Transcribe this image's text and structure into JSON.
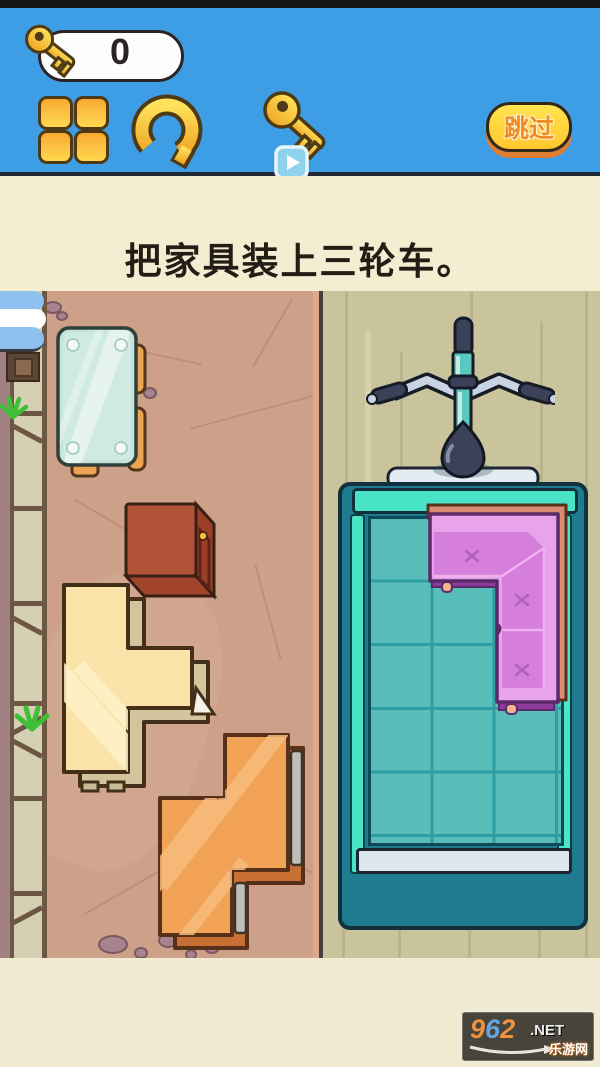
{
  "header": {
    "keys_count": "0",
    "skip_label": "跳过",
    "buttons": [
      "levels-grid",
      "restart",
      "key-hint-video",
      "skip"
    ],
    "accent_blue": "#3E9EE5",
    "gold": "#FFD23E"
  },
  "instruction": "把家具装上三轮车。",
  "game": {
    "goal": "load furniture pieces onto the tricycle cart",
    "cart": {
      "grid_columns": 3,
      "grid_rows": 5,
      "bed_color": "#59BDB9",
      "frame_color": "#1F7B90",
      "rail_color": "#4AE4C7",
      "loaded_piece": "purple-corner-sofa"
    },
    "pieces": [
      {
        "name": "glass-table",
        "color": "#C6E4DC",
        "shape": "rectangle"
      },
      {
        "name": "red-nightstand-box",
        "color": "#B25239",
        "shape": "cube"
      },
      {
        "name": "cream-sofa-piece",
        "color": "#FBE4A9",
        "shape": "T-tetromino"
      },
      {
        "name": "orange-wardrobe-piece",
        "color": "#F2A254",
        "shape": "S-tetromino"
      },
      {
        "name": "purple-corner-sofa",
        "color": "#D780DB",
        "shape": "L-corner"
      }
    ],
    "floor_left_color": "#CDA089",
    "floor_right_color": "#CAC49D"
  },
  "watermark": {
    "d9": "9",
    "d6": "6",
    "d2": "2",
    "net": ".NET",
    "site_name": "乐游网"
  }
}
